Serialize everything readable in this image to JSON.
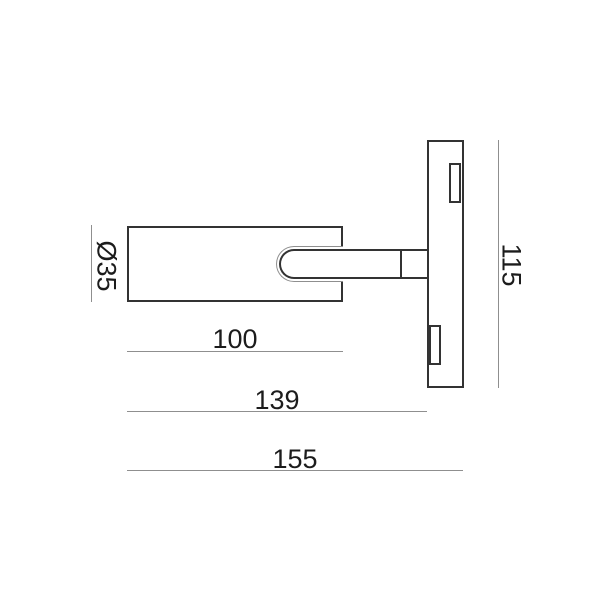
{
  "drawing": {
    "labels": {
      "diameter": "Ø35",
      "body_length": "100",
      "mount_depth": "139",
      "total_length": "155",
      "plate_height": "115"
    },
    "colors": {
      "background": "#ffffff",
      "outline": "#333333",
      "dimension_line": "#8f8f8f",
      "text": "#1c1c1c"
    }
  }
}
